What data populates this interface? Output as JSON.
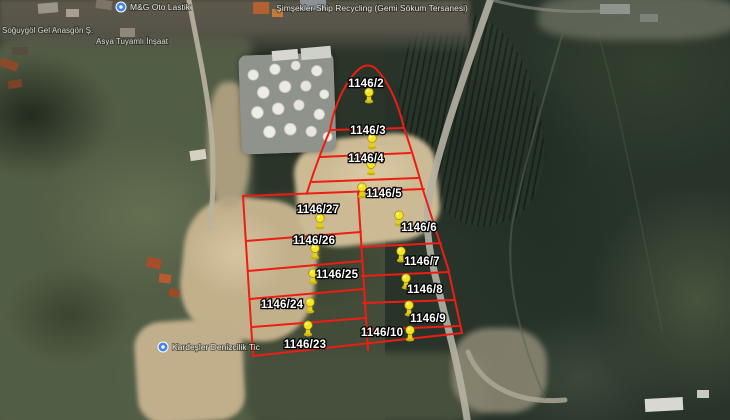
{
  "view": {
    "type": "satellite-map",
    "description": "Aerial imagery with cadastral parcel overlay"
  },
  "poi": {
    "shipyard": "Şimşekler Ship Recycling (Gemi Sökum Tersanesi)",
    "oto": "M&G Oto Lastik",
    "left_line1": "Soğuygöl Gel Anasgön Ş.",
    "left_line2": "Asya Tuyamlı İnşaat",
    "marina": "Kardeşler Denizcilik Tic"
  },
  "overlay": {
    "parcel_prefix": "1146",
    "parcels": [
      {
        "label": "1146/2"
      },
      {
        "label": "1146/3"
      },
      {
        "label": "1146/4"
      },
      {
        "label": "1146/5"
      },
      {
        "label": "1146/27"
      },
      {
        "label": "1146/6"
      },
      {
        "label": "1146/26"
      },
      {
        "label": "1146/7"
      },
      {
        "label": "1146/25"
      },
      {
        "label": "1146/8"
      },
      {
        "label": "1146/24"
      },
      {
        "label": "1146/9"
      },
      {
        "label": "1146/10"
      },
      {
        "label": "1146/23"
      }
    ]
  },
  "colors": {
    "parcel_line": "#ee1d14",
    "pushpin_yellow": "#f7e51f",
    "parcel_label_text": "#ffffff",
    "poi_icon_blue": "#4285f4"
  },
  "icons": {
    "pushpin": "yellow map pushpin",
    "poi": "blue circular place marker"
  }
}
